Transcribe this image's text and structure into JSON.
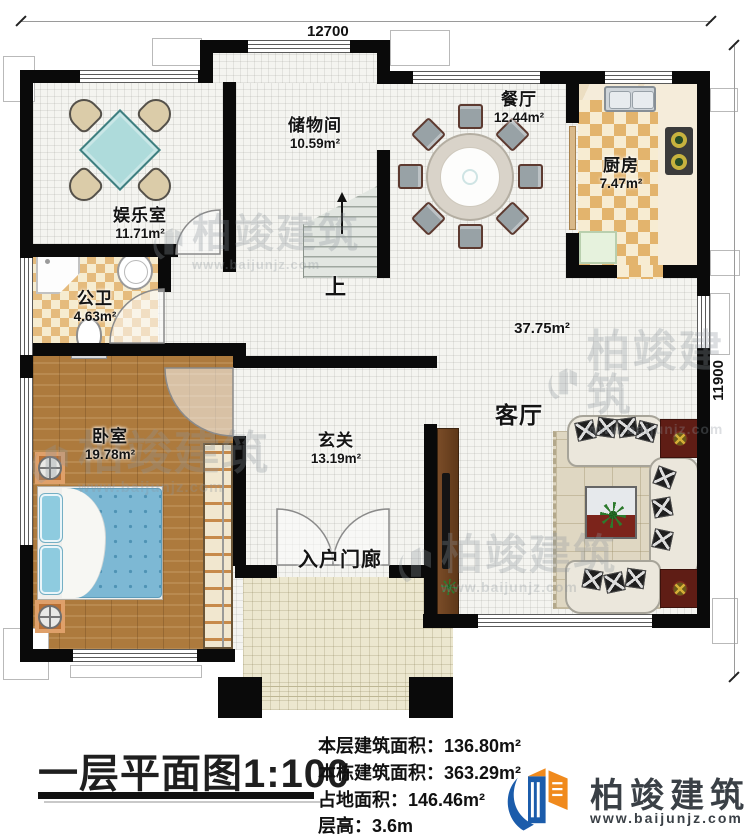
{
  "dimensions": {
    "width_label": "12700",
    "height_label": "11900"
  },
  "rooms": {
    "entertainment": {
      "name": "娱乐室",
      "area": "11.71m²"
    },
    "storage": {
      "name": "储物间",
      "area": "10.59m²"
    },
    "dining": {
      "name": "餐厅",
      "area": "12.44m²"
    },
    "kitchen": {
      "name": "厨房",
      "area": "7.47m²"
    },
    "bathroom": {
      "name": "公卫",
      "area": "4.63m²"
    },
    "bedroom": {
      "name": "卧室",
      "area": "19.78m²"
    },
    "hall": {
      "name": "玄关",
      "area": "13.19m²"
    },
    "living": {
      "name": "客厅",
      "area": "37.75m²"
    },
    "porch": {
      "name": "入户门廊"
    },
    "stairs": {
      "direction_label": "上"
    }
  },
  "footer": {
    "title": "一层平面图1:100",
    "stats": [
      {
        "label": "本层建筑面积：",
        "value": "136.80m²"
      },
      {
        "label": "本栋建筑面积：",
        "value": "363.29m²"
      },
      {
        "label": "占地面积：",
        "value": "146.46m²"
      },
      {
        "label": "层高：",
        "value": "3.6m"
      }
    ],
    "brand": {
      "name": "柏竣建筑",
      "url": "www.baijunjz.com"
    }
  },
  "watermark": {
    "name": "柏竣建筑",
    "url": "www.baijunjz.com"
  },
  "colors": {
    "wall": "#0a0a0a",
    "brand_blue": "#1b5cab",
    "brand_orange": "#f08a1d",
    "wood": "#ad7a3d",
    "bed_blue": "#7db8d4",
    "accent_red": "#5f1d15"
  }
}
